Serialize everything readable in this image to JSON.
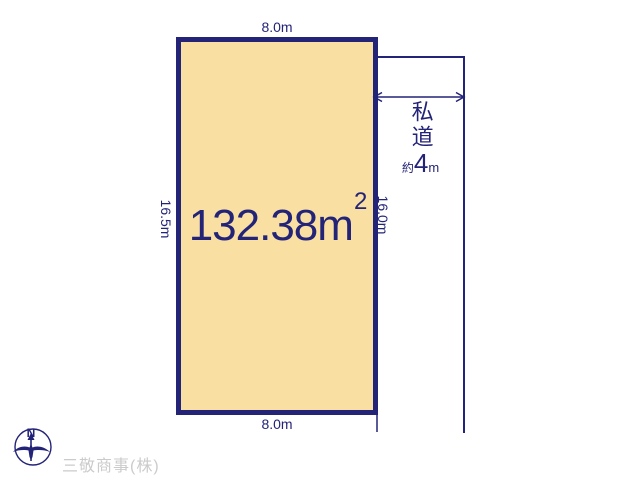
{
  "parcel": {
    "area_value": "132.38",
    "area_unit": "m",
    "area_sup": "2",
    "dim_top": "8.0m",
    "dim_bottom": "8.0m",
    "dim_left": "16.5m",
    "dim_right": "16.0m"
  },
  "road": {
    "label": "私道",
    "approx_prefix": "約",
    "width_value": "4",
    "width_unit": "m"
  },
  "compass": {
    "north_label": "N"
  },
  "footer": {
    "company": "三敬商事(株)"
  },
  "colors": {
    "navy": "#232378",
    "parcel_fill": "#f9dfa2",
    "watermark_gray": "#cbcbcb"
  }
}
